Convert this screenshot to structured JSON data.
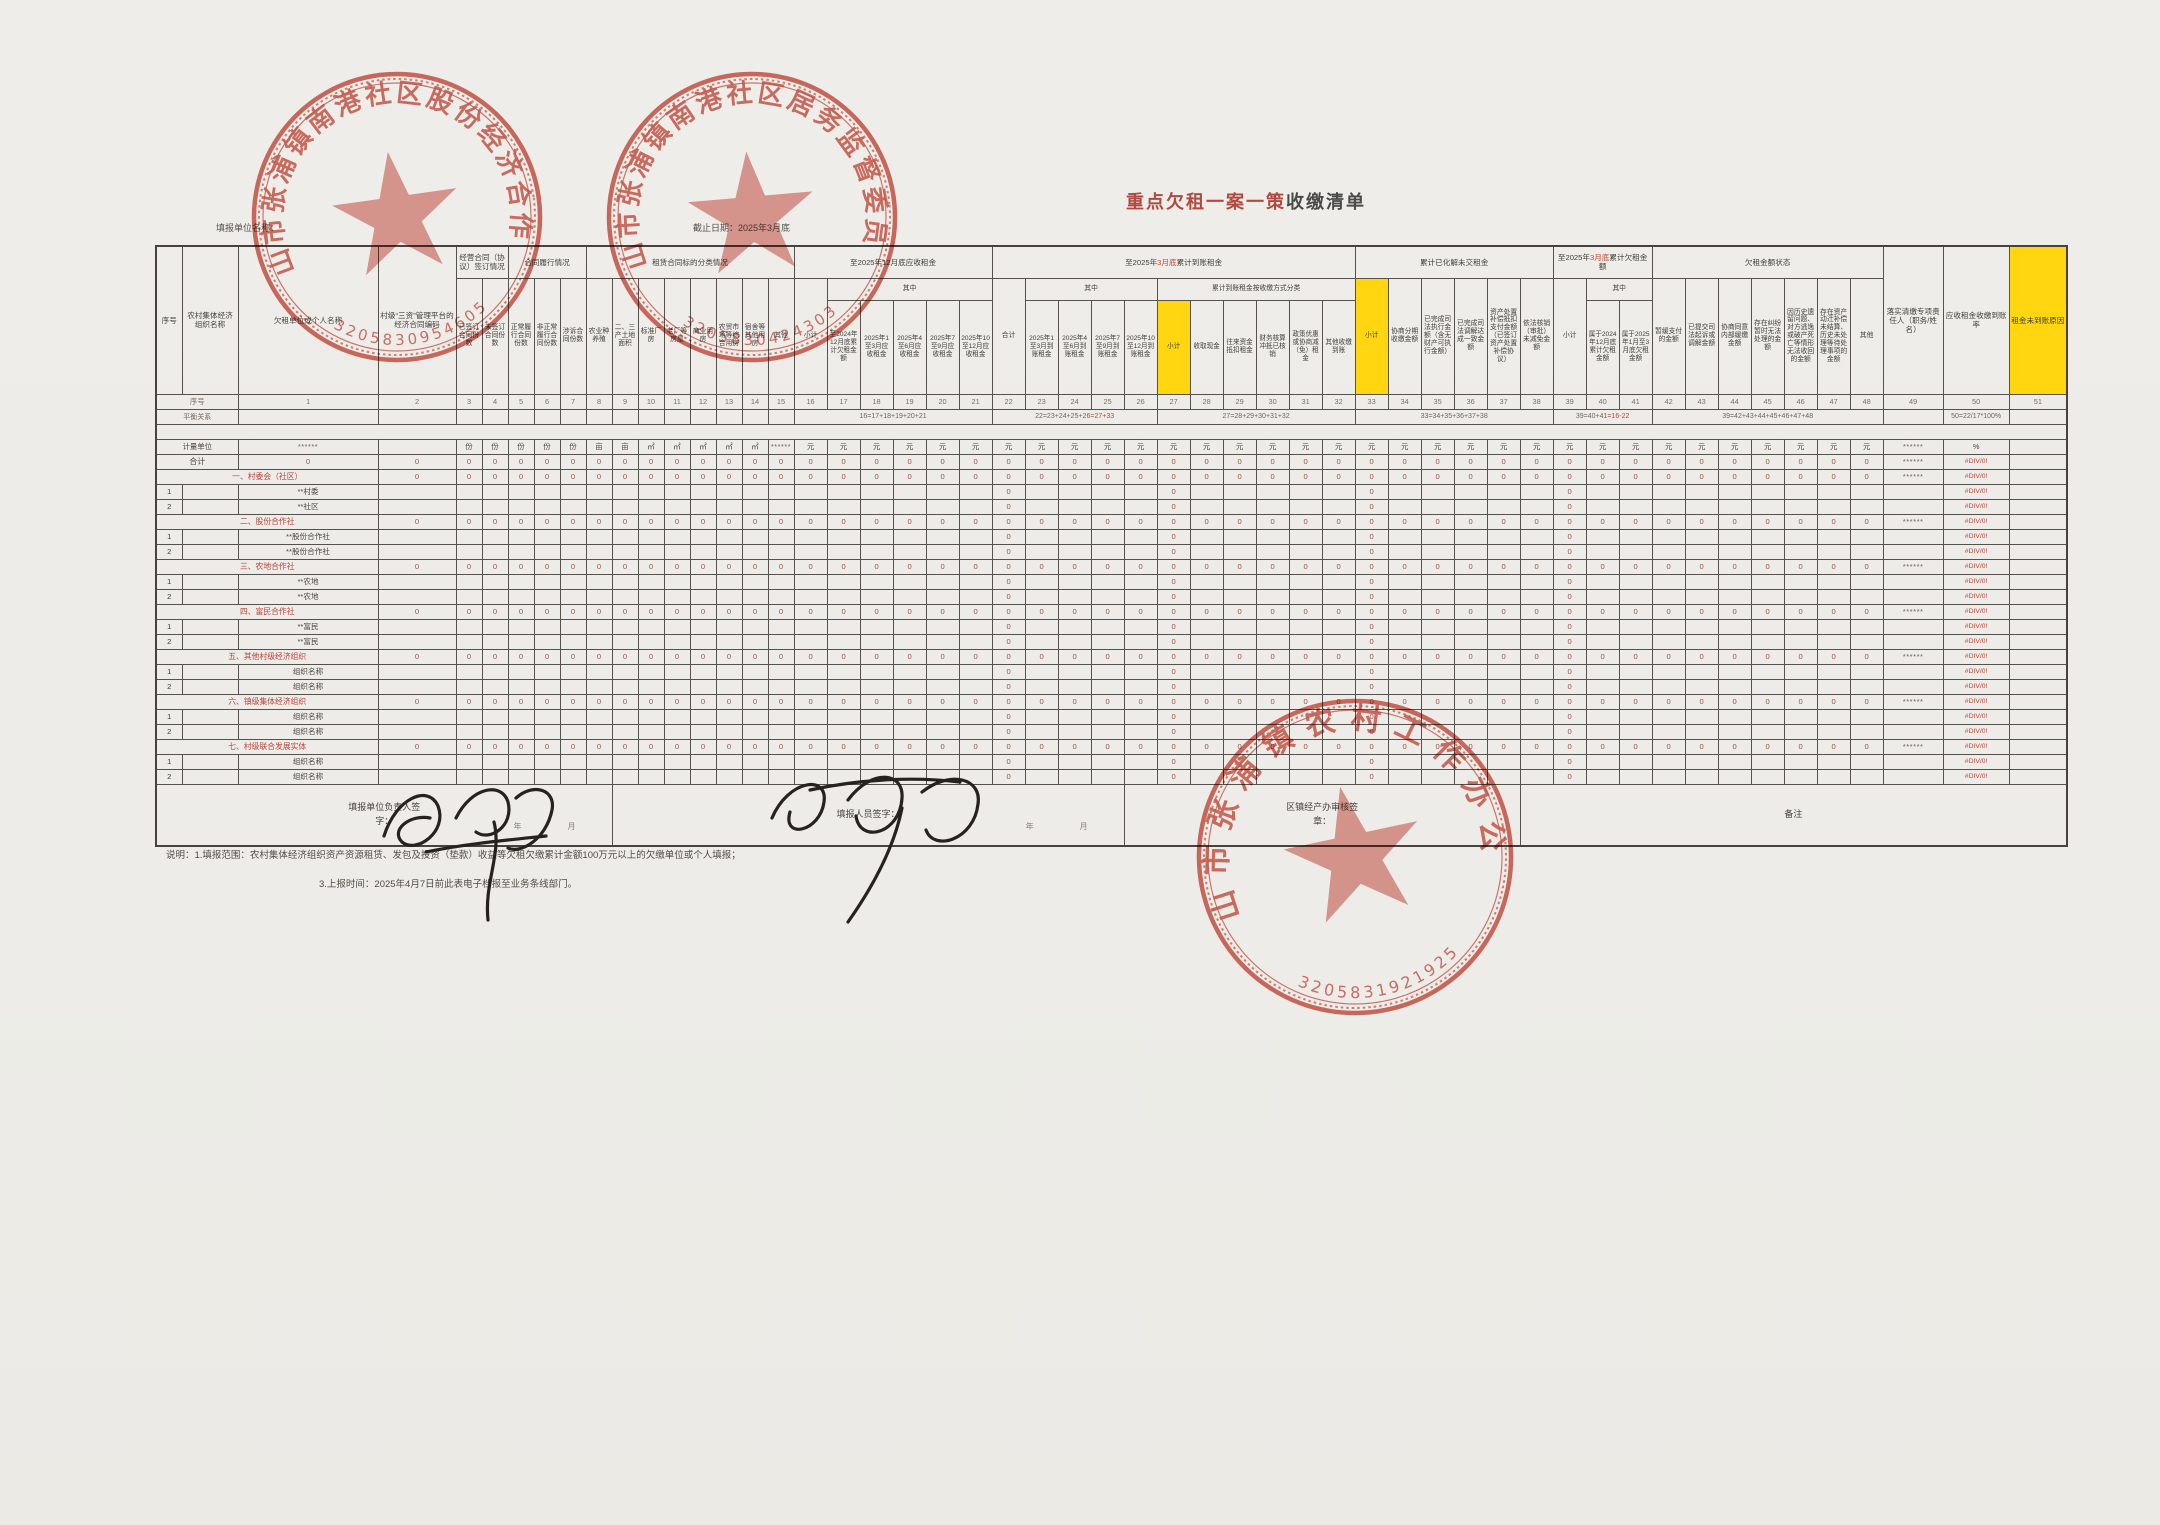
{
  "page": {
    "title_red": "重点欠租一案一策",
    "title_dark": "收缴清单",
    "unit_name_label": "填报单位名称：",
    "deadline_label": "截止日期：2025年3月底"
  },
  "colors": {
    "stamp_red": "#c63b2b",
    "highlight_yellow": "#ffd60f",
    "section_red": "#b5443a",
    "value_red": "#9a5148",
    "error_red": "#c0452f"
  },
  "stamps": [
    {
      "org": "昆山市张浦镇南港社区股份经济合作社",
      "number": "3205830954605"
    },
    {
      "org": "昆山市张浦镇南港社区居务监督委员会",
      "number": "3205830424303"
    },
    {
      "org": "昆山市张浦镇农村工作办公室",
      "number": "3205831921925"
    }
  ],
  "signatures": [
    {
      "role_label": "填报单位负责人签字：",
      "handwriting": "吴永峰"
    },
    {
      "role_label": "填报人员签字：",
      "handwriting": "姜月春"
    }
  ],
  "table": {
    "col_widths": [
      26,
      56,
      140,
      78,
      26,
      26,
      26,
      26,
      26,
      26,
      26,
      26,
      26,
      26,
      26,
      26,
      26,
      33,
      33,
      33,
      33,
      33,
      33,
      33,
      33,
      33,
      33,
      33,
      33,
      33,
      33,
      33,
      33,
      33,
      33,
      33,
      33,
      33,
      33,
      33,
      33,
      33,
      33,
      33,
      33,
      33,
      33,
      33,
      33,
      33,
      60,
      66,
      58
    ],
    "header_row1": [
      {
        "t": "序号",
        "rs": 3
      },
      {
        "t": "农村集体经济组织名称",
        "rs": 3
      },
      {
        "t": "欠租单位或个人名称",
        "rs": 3
      },
      {
        "t": "村级“三资”管理平台的经济合同编码",
        "rs": 3
      },
      {
        "t": "经营合同（协议）签订情况",
        "cs": 2
      },
      {
        "t": "合同履行情况",
        "cs": 3
      },
      {
        "t": "租赁合同标的分类情况",
        "cs": 8
      },
      {
        "t": "至2025年12月底应收租金",
        "cs": 6
      },
      {
        "pre": "至2025年",
        "red": "3月底",
        "post": "累计到账租金",
        "cs": 11
      },
      {
        "t": "累计已化解未交租金",
        "cs": 6
      },
      {
        "pre": "至2025年",
        "red": "3月底",
        "post": "累计欠租金额",
        "cs": 3
      },
      {
        "t": "欠租金额状态",
        "cs": 7
      },
      {
        "t": "落实清缴专项责任人（职务/姓名）",
        "rs": 3
      },
      {
        "t": "应收租金收缴到账率",
        "rs": 3
      },
      {
        "t": "租金未到账原因",
        "rs": 3,
        "hl": true
      }
    ],
    "header_row2": [
      {
        "t": "已签订合同份数",
        "rs": 2
      },
      {
        "t": "未签订合同份数",
        "rs": 2
      },
      {
        "t": "正常履行合同份数",
        "rs": 2
      },
      {
        "t": "非正常履行合同份数",
        "rs": 2
      },
      {
        "t": "涉诉合同份数",
        "rs": 2
      },
      {
        "t": "农业种养殖",
        "rs": 2
      },
      {
        "t": "二、三产土地面积",
        "rs": 2
      },
      {
        "t": "标准厂房",
        "rs": 2
      },
      {
        "t": "老厂等房屋",
        "rs": 2
      },
      {
        "t": "商业用房",
        "rs": 2
      },
      {
        "t": "农贸市场等综合用房",
        "rs": 2
      },
      {
        "t": "宿舍等其他用房",
        "rs": 2
      },
      {
        "t": "其他",
        "rs": 2
      },
      {
        "t": "小计",
        "rs": 2
      },
      {
        "t": "其中",
        "cs": 5
      },
      {
        "t": "合计",
        "rs": 2
      },
      {
        "t": "其中",
        "cs": 4
      },
      {
        "t": "累计到账租金按收缴方式分类",
        "cs": 6
      },
      {
        "t": "小计",
        "rs": 2,
        "hl": true
      },
      {
        "t": "协商分期收缴金额",
        "rs": 2
      },
      {
        "t": "已完成司法执行金额（含无财产可执行金额）",
        "rs": 2
      },
      {
        "t": "已完成司法调解达成一致金额",
        "rs": 2
      },
      {
        "t": "资产处置补偿抵扣支付金额（已签订资产处置补偿协议）",
        "rs": 2
      },
      {
        "t": "依法核销（审批）未减免金额",
        "rs": 2
      },
      {
        "t": "小计",
        "rs": 2
      },
      {
        "t": "其中",
        "cs": 2
      },
      {
        "t": "暂缓支付的金额",
        "rs": 2
      },
      {
        "t": "已提交司法起诉或调解金额",
        "rs": 2
      },
      {
        "t": "协商同意内部缓缴金额",
        "rs": 2
      },
      {
        "t": "存在纠纷暂时无法处理的金额",
        "rs": 2
      },
      {
        "t": "因历史遗留问题、对方逃逸或破产死亡等情形无法收回的金额",
        "rs": 2
      },
      {
        "t": "存在资产动迁补偿未结算、历史未处理等待处理事项的金额",
        "rs": 2
      },
      {
        "t": "其他",
        "rs": 2
      }
    ],
    "header_row3": [
      {
        "t": "至2024年12月底累计欠租金额"
      },
      {
        "t": "2025年1至3月应收租金"
      },
      {
        "t": "2025年4至6月应收租金"
      },
      {
        "t": "2025年7至9月应收租金"
      },
      {
        "t": "2025年10至12月应收租金"
      },
      {
        "t": "2025年1至3月到账租金"
      },
      {
        "t": "2025年4至6月到账租金"
      },
      {
        "t": "2025年7至9月到账租金"
      },
      {
        "t": "2025年10至12月到账租金"
      },
      {
        "t": "小计",
        "hl": true
      },
      {
        "t": "收取现金"
      },
      {
        "t": "往来资金抵扣租金"
      },
      {
        "t": "财务核算冲抵已核销"
      },
      {
        "t": "政策优惠或协商减（免）租金"
      },
      {
        "t": "其他收缴到账"
      },
      {
        "t": "属于2024年12月底累计欠租金额"
      },
      {
        "t": "属于2025年1月至3月底欠租金额"
      }
    ],
    "serial_label": "序号",
    "balance_label": "平衡关系",
    "balance_formulas": [
      {
        "cs": 6,
        "t": "16=17+18+19+20+21"
      },
      {
        "cs": 5,
        "t": "22=23+24+25+26",
        "red": "=27+33"
      },
      {
        "cs": 6,
        "t": "27=28+29+30+31+32"
      },
      {
        "cs": 6,
        "t": "33=34+35+36+37+38"
      },
      {
        "cs": 3,
        "t": "39=40+41",
        "red": "=16-22"
      },
      {
        "cs": 7,
        "t": "39=42+43+44+45+46+47+48"
      },
      {
        "cs": 1,
        "t": ""
      },
      {
        "cs": 1,
        "t": "50=22/17*100%"
      },
      {
        "cs": 1,
        "t": ""
      }
    ],
    "unit_label": "计量单位",
    "units": [
      "******",
      "",
      "份",
      "份",
      "份",
      "份",
      "份",
      "亩",
      "亩",
      "㎡",
      "㎡",
      "㎡",
      "㎡",
      "㎡",
      "******",
      "元",
      "元",
      "元",
      "元",
      "元",
      "元",
      "元",
      "元",
      "元",
      "元",
      "元",
      "元",
      "元",
      "元",
      "元",
      "元",
      "元",
      "元",
      "元",
      "元",
      "元",
      "元",
      "元",
      "元",
      "元",
      "元",
      "元",
      "元",
      "元",
      "元",
      "元",
      "元",
      "元",
      "******",
      "%",
      ""
    ],
    "cell_strings": {
      "zero": "0",
      "stars": "******",
      "error": "#DIV/0!"
    },
    "detail_zero_cols": [
      22,
      27,
      33,
      39
    ],
    "body_rows": [
      {
        "type": "total",
        "label": "合计"
      },
      {
        "type": "section",
        "label": "一、村委会（社区）"
      },
      {
        "type": "detail",
        "num": "1",
        "label": "**村委"
      },
      {
        "type": "detail",
        "num": "2",
        "label": "**社区"
      },
      {
        "type": "section",
        "label": "二、股份合作社"
      },
      {
        "type": "detail",
        "num": "1",
        "label": "**股份合作社"
      },
      {
        "type": "detail",
        "num": "2",
        "label": "**股份合作社"
      },
      {
        "type": "section",
        "label": "三、农地合作社"
      },
      {
        "type": "detail",
        "num": "1",
        "label": "**农地"
      },
      {
        "type": "detail",
        "num": "2",
        "label": "**农地"
      },
      {
        "type": "section",
        "label": "四、富民合作社"
      },
      {
        "type": "detail",
        "num": "1",
        "label": "**富民"
      },
      {
        "type": "detail",
        "num": "2",
        "label": "**富民"
      },
      {
        "type": "section",
        "label": "五、其他村级经济组织"
      },
      {
        "type": "detail",
        "num": "1",
        "label": "组织名称"
      },
      {
        "type": "detail",
        "num": "2",
        "label": "组织名称"
      },
      {
        "type": "section",
        "label": "六、镇级集体经济组织"
      },
      {
        "type": "detail",
        "num": "1",
        "label": "组织名称"
      },
      {
        "type": "detail",
        "num": "2",
        "label": "组织名称"
      },
      {
        "type": "section",
        "label": "七、村级联合发展实体"
      },
      {
        "type": "detail",
        "num": "1",
        "label": "组织名称"
      },
      {
        "type": "detail",
        "num": "2",
        "label": "组织名称"
      }
    ],
    "footer_cells": [
      {
        "cs": 10,
        "label": "填报单位负责人签字：",
        "hint": "年　　月"
      },
      {
        "cs": 17,
        "label": "填报人员签字：",
        "hint": "年　　月"
      },
      {
        "cs": 12,
        "label": "区镇经产办审核签章："
      },
      {
        "cs": 14,
        "label": "备注"
      }
    ]
  },
  "notes": [
    "说明：1.填报范围：农村集体经济组织资产资源租赁、发包及投资（垫款）收益等欠租欠缴累计金额100万元以上的欠缴单位或个人填报；",
    "3.上报时间：2025年4月7日前此表电子档报至业务条线部门。"
  ]
}
